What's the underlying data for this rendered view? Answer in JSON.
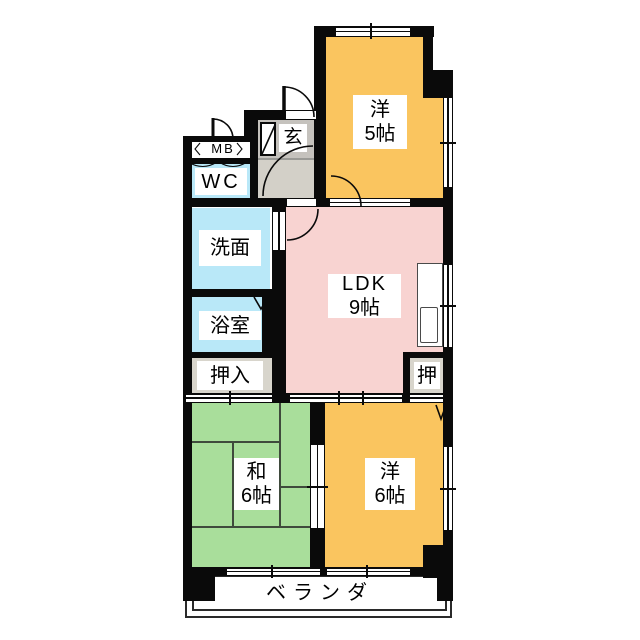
{
  "palette": {
    "wall": "#0a0a0a",
    "western_room": "#fac55f",
    "ldk": "#f8d3d1",
    "japanese_room": "#a9de9b",
    "water_rooms": "#b9e8f8",
    "closet": "#d8d5cc",
    "entrance_tataki": "#c5c2bd",
    "entrance_hall": "#d3d0c8"
  },
  "rooms": {
    "western5": {
      "name": "洋",
      "size": "5帖"
    },
    "ldk": {
      "name": "LDK",
      "size": "9帖"
    },
    "japanese6": {
      "name": "和",
      "size": "6帖"
    },
    "western6": {
      "name": "洋",
      "size": "6帖"
    },
    "wc": {
      "name": "WC"
    },
    "washroom": {
      "name": "洗面"
    },
    "bathroom": {
      "name": "浴室"
    },
    "closet": {
      "name": "押入"
    },
    "closet_small": {
      "name": "押"
    },
    "entrance": {
      "name": "玄"
    },
    "meter_box": {
      "name": "MB"
    },
    "veranda": {
      "name": "ベランダ"
    }
  }
}
